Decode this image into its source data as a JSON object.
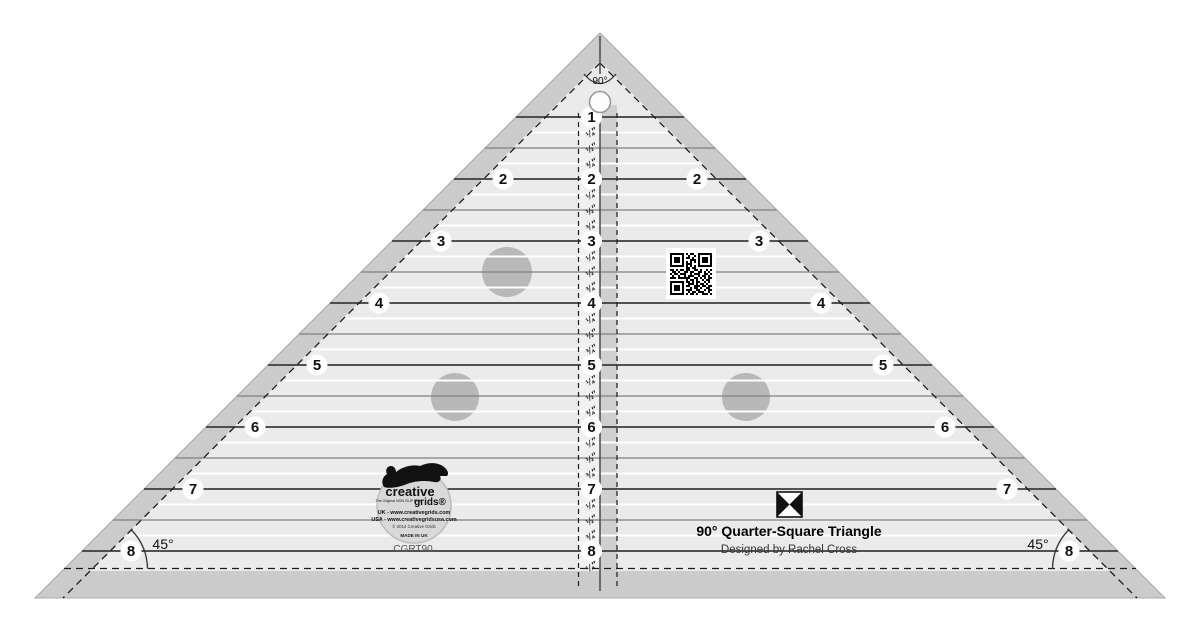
{
  "ruler": {
    "model": "CGRT90",
    "title": "90° Quarter-Square Triangle",
    "subtitle": "Designed by Rachel Cross",
    "apex_angle_label": "90°",
    "corner_angle_label": "45°",
    "center_numbers": [
      "1",
      "2",
      "3",
      "4",
      "5",
      "6",
      "7",
      "8"
    ],
    "edge_numbers": [
      "2",
      "3",
      "4",
      "5",
      "6",
      "7",
      "8"
    ],
    "fraction_labels": [
      "¼″",
      "½″",
      "¾″"
    ],
    "bottom_fraction_label": "¼″",
    "logo": {
      "brand_top": "creative",
      "brand_bottom": "grids®",
      "tagline": "The Original NON-SLIP Ruler",
      "line_uk": "UK - www.creativegrids.com",
      "line_usa": "USA - www.creativegridsusa.com",
      "line_copyright": "© 2014 Creative Grids",
      "line_made": "MADE IN UK"
    },
    "colors": {
      "band": "#cbcbcb",
      "band_edge": "#a8a8a8",
      "body": "#ebebeb",
      "strip_light": "#f1f1f1",
      "strip_gray": "#cfcfcf",
      "grip_dot": "#b8b8b8",
      "line_whole": "#3c3c3c",
      "line_half": "#818181",
      "line_quarter": "#ffffff",
      "dash": "#1c1c1c",
      "hole_ring": "#9a9a9a",
      "badge": "#ffffff",
      "text": "#111111"
    },
    "qr_bitmap": [
      "111111101011001111111",
      "100000100100101000001",
      "101110101101001011101",
      "101110100011101011101",
      "101110101010101011101",
      "100000101110001000001",
      "111111101010101111111",
      "000000001101100000000",
      "110101101100110100101",
      "011010011011001101010",
      "101101110010111001101",
      "010010010111001011010",
      "111011111100110101011",
      "000000001011010010110",
      "111111101101011001010",
      "100000100111010110100",
      "101110101100111011011",
      "101110100010110100110",
      "101110101110011001011",
      "100000100101101110010",
      "111111101011010011101"
    ]
  }
}
